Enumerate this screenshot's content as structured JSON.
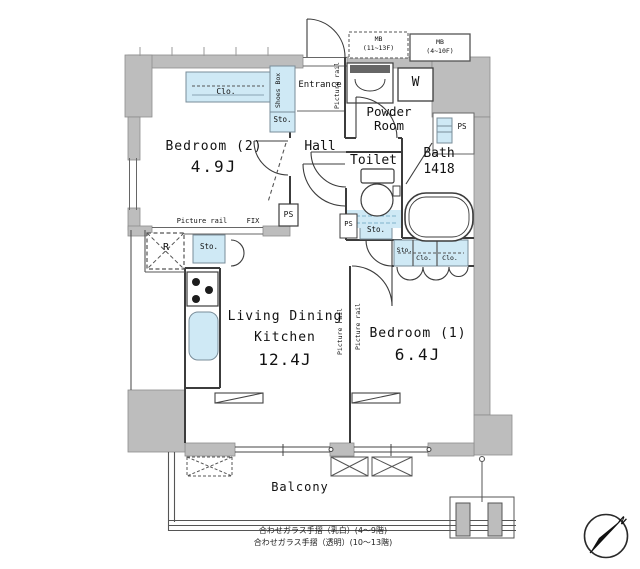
{
  "plan": {
    "rooms": {
      "bedroom2": {
        "name": "Bedroom (2)",
        "size": "4.9J"
      },
      "bedroom1": {
        "name": "Bedroom (1)",
        "size": "6.4J"
      },
      "ldk": {
        "line1": "Living Dining",
        "line2": "Kitchen",
        "size": "12.4J"
      },
      "hall": "Hall",
      "toilet": "Toilet",
      "bath": {
        "name": "Bath",
        "size": "1418"
      },
      "powder": {
        "line1": "Powder",
        "line2": "Room"
      },
      "entrance": "Entrance",
      "balcony": "Balcony"
    },
    "labels": {
      "clo": "Clo.",
      "sto": "Sto.",
      "shoes_box": "Shoes Box",
      "picture_rail": "Picture rail",
      "fix": "FIX",
      "ps": "PS",
      "washer": "W",
      "fridge": "R",
      "mb_upper": {
        "line1": "MB",
        "line2": "(11~13F)"
      },
      "mb_lower": {
        "line1": "MB",
        "line2": "(4~10F)"
      }
    },
    "notes": {
      "line1": "合わせガラス手摺（乳白）(4〜9階)",
      "line2": "合わせガラス手摺（透明）(10〜13階)"
    },
    "compass": {
      "north": "N"
    },
    "colors": {
      "wall_gray": "#bdbdbd",
      "fixture_blue": "#cfe9f5",
      "line_dark": "#3c3c3c"
    }
  }
}
